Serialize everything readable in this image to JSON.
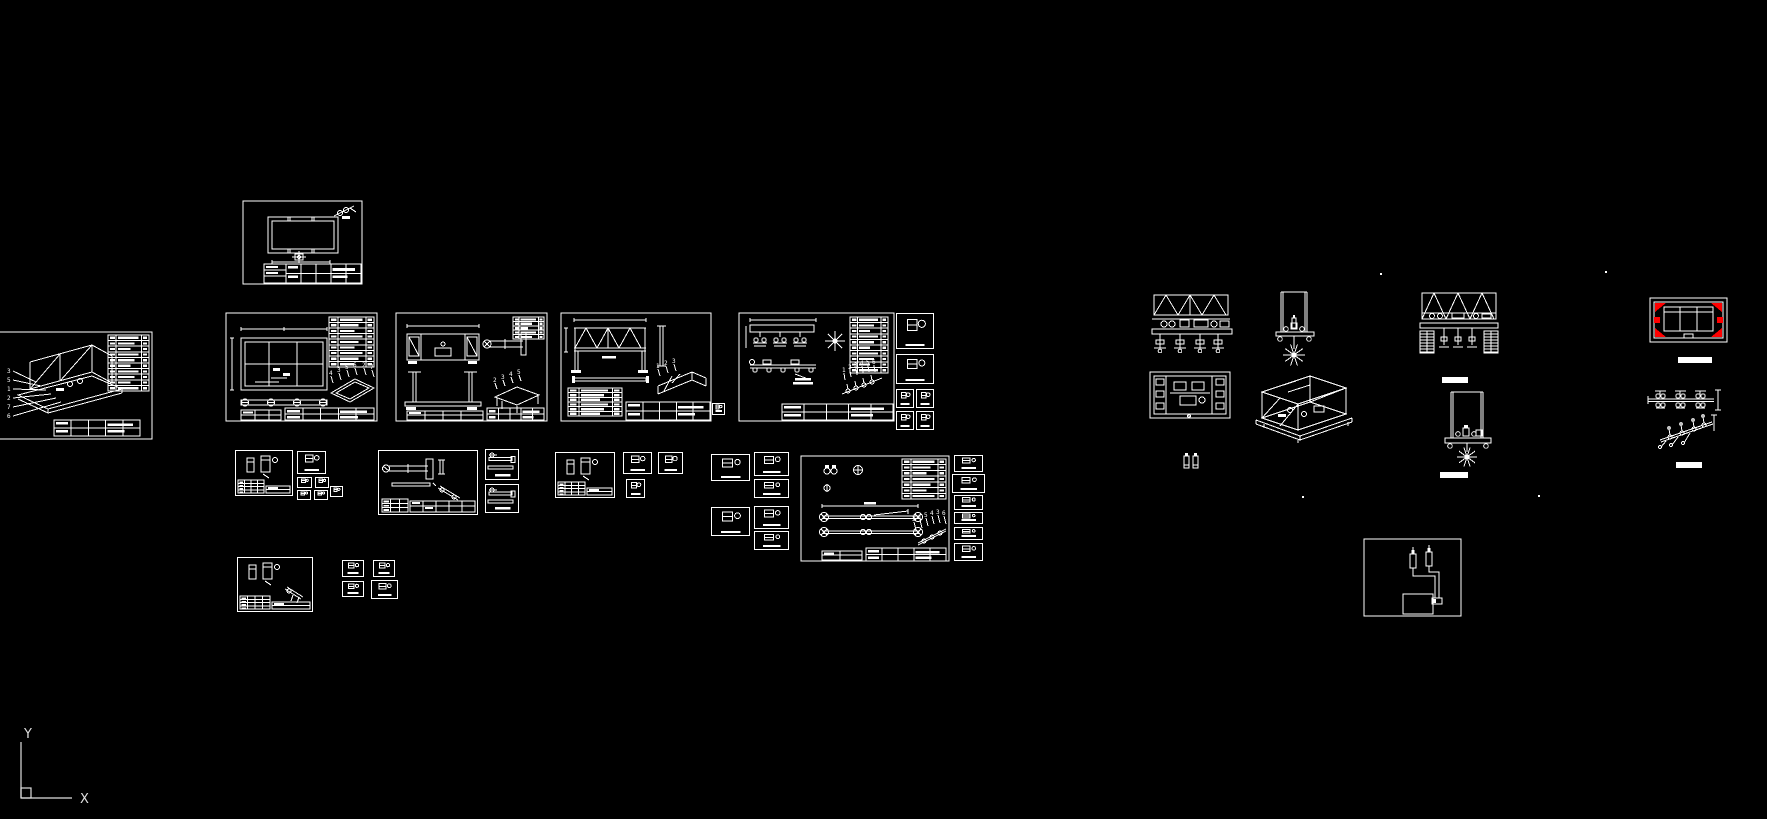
{
  "app": {
    "background": "#000000",
    "line_color": "#ffffff",
    "accent_color": "#ff0000"
  },
  "ucs": {
    "y_label": "Y",
    "x_label": "X"
  },
  "leaders": {
    "assembly": [
      "3",
      "5",
      "1",
      "2",
      "7",
      "6"
    ],
    "frame_iso": [
      "4",
      "3",
      "5",
      "6",
      "2",
      "7"
    ],
    "bench_iso": [
      "2",
      "3",
      "4",
      "5"
    ],
    "truss_iso": [
      "1",
      "2",
      "3"
    ],
    "roller_iso": [
      "1",
      "2",
      "3",
      "4",
      "5",
      "6"
    ],
    "axle_iso": [
      "2",
      "1",
      "5",
      "4",
      "3",
      "6"
    ]
  },
  "scene": {
    "width": 1767,
    "height": 819,
    "panels": [
      {
        "name": "assembly-iso-sheet",
        "kind": "cut-assembly-sheet",
        "x": 0,
        "y": 332,
        "w": 152,
        "h": 107
      },
      {
        "name": "frame-plan-sheet",
        "kind": "plan-sheet",
        "x": 242,
        "y": 200,
        "w": 121,
        "h": 85
      },
      {
        "name": "frame-detail-sheet",
        "kind": "frame-plan-sheet",
        "x": 225,
        "y": 312,
        "w": 153,
        "h": 110
      },
      {
        "name": "bench-weldment-sheet",
        "kind": "bench-sheet",
        "x": 395,
        "y": 312,
        "w": 153,
        "h": 110
      },
      {
        "name": "truss-girder-sheet",
        "kind": "truss-sheet",
        "x": 560,
        "y": 312,
        "w": 152,
        "h": 110
      },
      {
        "name": "roller-line-sheet",
        "kind": "roller-sheet",
        "x": 738,
        "y": 312,
        "w": 157,
        "h": 110
      },
      {
        "name": "detail-box",
        "kind": "detail-box",
        "x": 896,
        "y": 313,
        "w": 38,
        "h": 36
      },
      {
        "name": "detail-box",
        "kind": "detail-box",
        "x": 896,
        "y": 354,
        "w": 38,
        "h": 30
      },
      {
        "name": "detail-box",
        "kind": "detail-box",
        "x": 896,
        "y": 389,
        "w": 18,
        "h": 19
      },
      {
        "name": "detail-box",
        "kind": "detail-box",
        "x": 916,
        "y": 389,
        "w": 18,
        "h": 19
      },
      {
        "name": "detail-box",
        "kind": "detail-box",
        "x": 896,
        "y": 411,
        "w": 18,
        "h": 19
      },
      {
        "name": "detail-box",
        "kind": "detail-box",
        "x": 916,
        "y": 411,
        "w": 18,
        "h": 19
      },
      {
        "name": "detail-box",
        "kind": "detail-box",
        "x": 712,
        "y": 403,
        "w": 13,
        "h": 12
      },
      {
        "name": "small-parts-sheet",
        "kind": "part-sheet-small",
        "x": 235,
        "y": 450,
        "w": 58,
        "h": 46
      },
      {
        "name": "detail-box",
        "kind": "detail-box",
        "x": 297,
        "y": 451,
        "w": 29,
        "h": 23
      },
      {
        "name": "detail-box",
        "kind": "detail-box",
        "x": 297,
        "y": 477,
        "w": 15,
        "h": 11
      },
      {
        "name": "detail-box",
        "kind": "detail-box",
        "x": 315,
        "y": 477,
        "w": 14,
        "h": 11
      },
      {
        "name": "detail-box",
        "kind": "detail-box",
        "x": 297,
        "y": 490,
        "w": 14,
        "h": 10
      },
      {
        "name": "detail-box",
        "kind": "detail-box",
        "x": 314,
        "y": 490,
        "w": 14,
        "h": 10
      },
      {
        "name": "detail-box",
        "kind": "detail-box",
        "x": 330,
        "y": 486,
        "w": 13,
        "h": 11
      },
      {
        "name": "shaft-parts-sheet",
        "kind": "part-sheet-small",
        "variant": "shaft",
        "x": 378,
        "y": 450,
        "w": 100,
        "h": 65
      },
      {
        "name": "bar-detail-box",
        "kind": "bar-box",
        "x": 485,
        "y": 449,
        "w": 34,
        "h": 31
      },
      {
        "name": "bar-detail-box",
        "kind": "bar-box",
        "x": 485,
        "y": 484,
        "w": 34,
        "h": 29
      },
      {
        "name": "small-parts-sheet",
        "kind": "part-sheet-small",
        "x": 555,
        "y": 452,
        "w": 60,
        "h": 46
      },
      {
        "name": "detail-box",
        "kind": "detail-box",
        "x": 623,
        "y": 452,
        "w": 29,
        "h": 22
      },
      {
        "name": "detail-box",
        "kind": "detail-box",
        "x": 658,
        "y": 452,
        "w": 25,
        "h": 22
      },
      {
        "name": "detail-box",
        "kind": "detail-box",
        "x": 626,
        "y": 479,
        "w": 19,
        "h": 19
      },
      {
        "name": "detail-box",
        "kind": "detail-box",
        "x": 711,
        "y": 454,
        "w": 39,
        "h": 27
      },
      {
        "name": "detail-box",
        "kind": "detail-box",
        "x": 754,
        "y": 452,
        "w": 35,
        "h": 24
      },
      {
        "name": "detail-box",
        "kind": "detail-box",
        "x": 754,
        "y": 479,
        "w": 35,
        "h": 19
      },
      {
        "name": "detail-box",
        "kind": "detail-box",
        "x": 711,
        "y": 507,
        "w": 39,
        "h": 29
      },
      {
        "name": "detail-box",
        "kind": "detail-box",
        "x": 754,
        "y": 506,
        "w": 35,
        "h": 23
      },
      {
        "name": "detail-box",
        "kind": "detail-box",
        "x": 754,
        "y": 531,
        "w": 35,
        "h": 19
      },
      {
        "name": "axle-assembly-sheet",
        "kind": "axle-sheet",
        "x": 800,
        "y": 455,
        "w": 150,
        "h": 107
      },
      {
        "name": "detail-box",
        "kind": "detail-box",
        "x": 954,
        "y": 455,
        "w": 29,
        "h": 17
      },
      {
        "name": "detail-box",
        "kind": "detail-box",
        "x": 952,
        "y": 474,
        "w": 33,
        "h": 19
      },
      {
        "name": "detail-box",
        "kind": "detail-box",
        "x": 954,
        "y": 495,
        "w": 29,
        "h": 15
      },
      {
        "name": "detail-box",
        "kind": "detail-box",
        "x": 954,
        "y": 512,
        "w": 29,
        "h": 12
      },
      {
        "name": "detail-box",
        "kind": "detail-box",
        "x": 954,
        "y": 527,
        "w": 29,
        "h": 13
      },
      {
        "name": "detail-box",
        "kind": "detail-box",
        "x": 954,
        "y": 543,
        "w": 29,
        "h": 18
      },
      {
        "name": "bracket-sheet",
        "kind": "part-sheet-small",
        "variant": "bracket",
        "x": 237,
        "y": 557,
        "w": 76,
        "h": 55
      },
      {
        "name": "detail-box",
        "kind": "detail-box",
        "x": 342,
        "y": 560,
        "w": 22,
        "h": 17
      },
      {
        "name": "detail-box",
        "kind": "detail-box",
        "x": 373,
        "y": 560,
        "w": 22,
        "h": 17
      },
      {
        "name": "detail-box",
        "kind": "detail-box",
        "x": 342,
        "y": 581,
        "w": 22,
        "h": 16
      },
      {
        "name": "detail-box",
        "kind": "detail-box",
        "x": 371,
        "y": 580,
        "w": 27,
        "h": 19
      },
      {
        "name": "machine-front-elevation",
        "kind": "front-elevation",
        "x": 1152,
        "y": 293,
        "w": 88,
        "h": 80
      },
      {
        "name": "machine-side-star-view",
        "kind": "tall-frame-star",
        "x": 1276,
        "y": 292,
        "w": 38,
        "h": 78
      },
      {
        "name": "machine-plan-view",
        "kind": "plan-view",
        "x": 1150,
        "y": 372,
        "w": 80,
        "h": 46
      },
      {
        "name": "machine-iso-view",
        "kind": "machine-iso",
        "x": 1248,
        "y": 368,
        "w": 104,
        "h": 78
      },
      {
        "name": "gas-cylinders",
        "kind": "cylinders-pair",
        "x": 1183,
        "y": 452,
        "w": 16,
        "h": 18
      },
      {
        "name": "crawler-elevation",
        "kind": "elev-tracks",
        "x": 1420,
        "y": 293,
        "w": 80,
        "h": 75
      },
      {
        "name": "caption-bar",
        "kind": "caption-bar",
        "x": 1442,
        "y": 377,
        "w": 26,
        "h": 6
      },
      {
        "name": "frame-star-elevation",
        "kind": "frame-star-side",
        "x": 1443,
        "y": 392,
        "w": 50,
        "h": 76
      },
      {
        "name": "caption-bar",
        "kind": "caption-bar",
        "x": 1440,
        "y": 472,
        "w": 28,
        "h": 6
      },
      {
        "name": "clamp-frame-plan",
        "kind": "red-corner-plan",
        "x": 1650,
        "y": 298,
        "w": 77,
        "h": 44
      },
      {
        "name": "caption-bar",
        "kind": "caption-bar",
        "x": 1678,
        "y": 357,
        "w": 34,
        "h": 6
      },
      {
        "name": "linkage-plan-view",
        "kind": "linkage-plan",
        "x": 1648,
        "y": 388,
        "w": 74,
        "h": 23
      },
      {
        "name": "linkage-iso-view",
        "kind": "linkage-iso",
        "x": 1656,
        "y": 412,
        "w": 66,
        "h": 36
      },
      {
        "name": "caption-bar",
        "kind": "caption-bar",
        "x": 1676,
        "y": 462,
        "w": 26,
        "h": 6
      },
      {
        "name": "pneumatic-schematic-sheet",
        "kind": "pneumatic-sheet",
        "x": 1363,
        "y": 538,
        "w": 99,
        "h": 79
      }
    ],
    "dots": [
      {
        "x": 1380,
        "y": 273
      },
      {
        "x": 1605,
        "y": 271
      },
      {
        "x": 1538,
        "y": 495
      },
      {
        "x": 1302,
        "y": 496
      }
    ]
  }
}
